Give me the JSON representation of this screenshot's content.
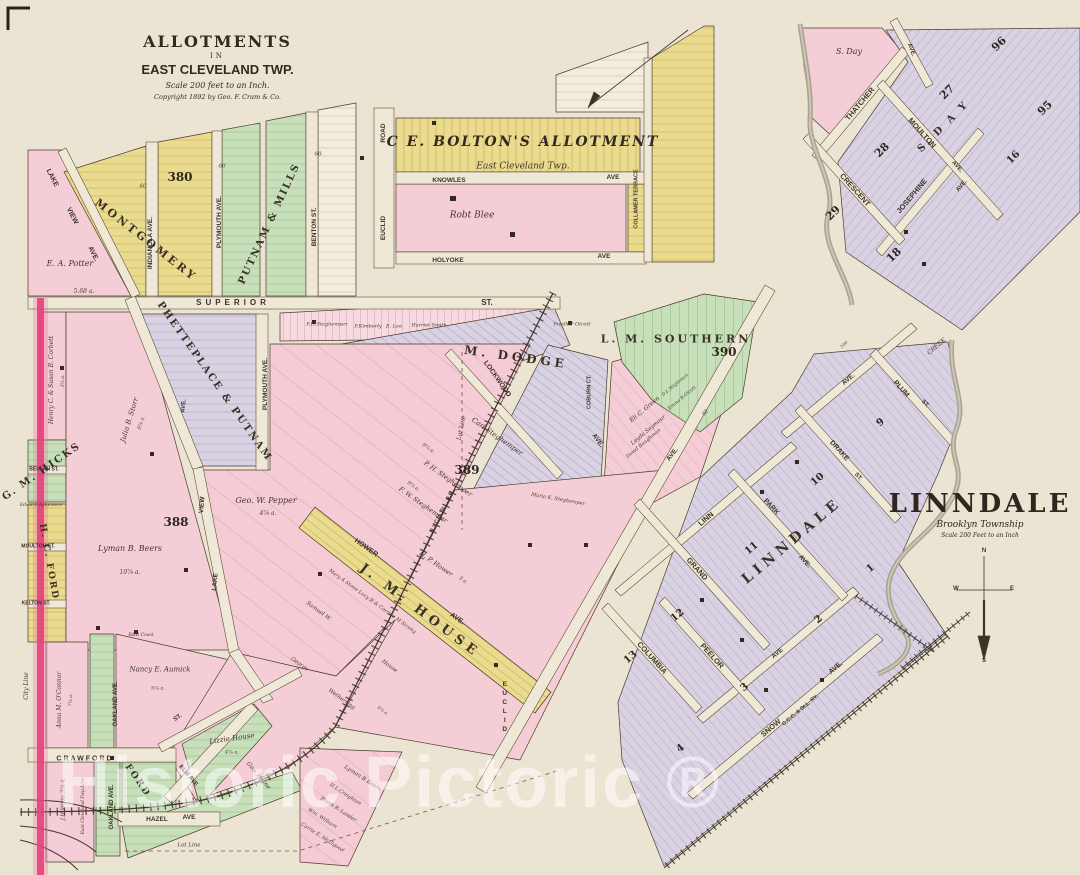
{
  "sheet": {
    "title_block": {
      "line1": "ALLOTMENTS",
      "line2": "IN",
      "line3": "EAST CLEVELAND TWP.",
      "line4": "Scale 200 feet to an Inch.",
      "line5": "Copyright 1892 by Geo. F. Cram & Co."
    },
    "linndale_title": {
      "title": "LINNDALE",
      "subtitle": "Brooklyn Township",
      "scale": "Scale 200 Feet to an Inch"
    },
    "watermark": "Historic Pictoric ®"
  },
  "colors": {
    "paper": "#ece4d3",
    "pink": "#f5cdd6",
    "yellow": "#eadb8d",
    "green": "#c7e0ba",
    "lavender": "#d9d2e3",
    "city_line": "#e63f7d",
    "creek": "#a9a291",
    "ink": "#4a3c2c",
    "watermark": "rgba(255,255,255,0.52)"
  },
  "map_labels": [
    {
      "t": "LAKE",
      "x": 52,
      "y": 178,
      "r": 63,
      "s": 7,
      "k": "st"
    },
    {
      "t": "VIEW",
      "x": 72,
      "y": 216,
      "r": 63,
      "s": 7,
      "k": "st"
    },
    {
      "t": "AVE.",
      "x": 93,
      "y": 254,
      "r": 63,
      "s": 7,
      "k": "st"
    },
    {
      "t": "E. A. Potter",
      "x": 70,
      "y": 264,
      "r": 0,
      "s": 8,
      "k": "ow"
    },
    {
      "t": "5.68 a.",
      "x": 84,
      "y": 292,
      "r": 0,
      "s": 6,
      "k": "ti"
    },
    {
      "t": "MONTGOMERY",
      "x": 146,
      "y": 240,
      "r": 38,
      "s": 11,
      "k": "al",
      "ls": 3
    },
    {
      "t": "380",
      "x": 180,
      "y": 177,
      "r": 0,
      "s": 12,
      "k": "nm"
    },
    {
      "t": "INDIANOLA AVE.",
      "x": 151,
      "y": 243,
      "r": -90,
      "s": 6.5,
      "k": "st"
    },
    {
      "t": "60",
      "x": 143,
      "y": 187,
      "r": 0,
      "s": 5.5,
      "k": "ti"
    },
    {
      "t": "60",
      "x": 222,
      "y": 167,
      "r": 0,
      "s": 5.5,
      "k": "ti"
    },
    {
      "t": "60",
      "x": 318,
      "y": 155,
      "r": 0,
      "s": 5.5,
      "k": "ti"
    },
    {
      "t": "PLYMOUTH AVE.",
      "x": 220,
      "y": 222,
      "r": -90,
      "s": 6.5,
      "k": "st"
    },
    {
      "t": "PUTNAM & MILLS",
      "x": 270,
      "y": 224,
      "r": -65,
      "s": 10,
      "k": "al",
      "ls": 2
    },
    {
      "t": "BENTON ST.",
      "x": 315,
      "y": 227,
      "r": -90,
      "s": 6.5,
      "k": "st"
    },
    {
      "t": "SUPERIOR",
      "x": 233,
      "y": 303,
      "r": 0,
      "s": 8,
      "k": "st",
      "ls": 4
    },
    {
      "t": "ST.",
      "x": 487,
      "y": 303,
      "r": 0,
      "s": 8,
      "k": "st"
    },
    {
      "t": "ROAD",
      "x": 384,
      "y": 133,
      "r": -90,
      "s": 6.5,
      "k": "st"
    },
    {
      "t": "EUCLID",
      "x": 384,
      "y": 228,
      "r": -90,
      "s": 6.5,
      "k": "st"
    },
    {
      "t": "C E. BOLTON'S ALLOTMENT",
      "x": 523,
      "y": 142,
      "r": 0,
      "s": 14,
      "k": "alit",
      "ls": 2,
      "n": "bolton-allotment-title"
    },
    {
      "t": "East Cleveland Twp.",
      "x": 523,
      "y": 167,
      "r": 0,
      "s": 9,
      "k": "ow",
      "n": "bolton-allotment-subtitle"
    },
    {
      "t": "KNOWLES",
      "x": 449,
      "y": 181,
      "r": 0,
      "s": 6.5,
      "k": "st"
    },
    {
      "t": "AVE",
      "x": 613,
      "y": 178,
      "r": 0,
      "s": 6.5,
      "k": "st"
    },
    {
      "t": "Robt Blee",
      "x": 472,
      "y": 216,
      "r": 0,
      "s": 9,
      "k": "ow"
    },
    {
      "t": "HOLYOKE",
      "x": 448,
      "y": 261,
      "r": 0,
      "s": 6.5,
      "k": "st"
    },
    {
      "t": "AVE",
      "x": 604,
      "y": 257,
      "r": 0,
      "s": 6.5,
      "k": "st"
    },
    {
      "t": "COLLAMER TERRACE",
      "x": 637,
      "y": 199,
      "r": -90,
      "s": 5.5,
      "k": "st"
    },
    {
      "t": "S. Day",
      "x": 849,
      "y": 52,
      "r": 0,
      "s": 8,
      "k": "ow"
    },
    {
      "t": "AVE.",
      "x": 911,
      "y": 50,
      "r": 70,
      "s": 6,
      "k": "st"
    },
    {
      "t": "96",
      "x": 999,
      "y": 44,
      "r": -45,
      "s": 11,
      "k": "nm"
    },
    {
      "t": "27",
      "x": 947,
      "y": 92,
      "r": -45,
      "s": 11,
      "k": "nm"
    },
    {
      "t": "95",
      "x": 1045,
      "y": 108,
      "r": -45,
      "s": 11,
      "k": "nm"
    },
    {
      "t": "28",
      "x": 882,
      "y": 150,
      "r": -45,
      "s": 11,
      "k": "nm"
    },
    {
      "t": "29",
      "x": 833,
      "y": 213,
      "r": -45,
      "s": 11,
      "k": "nm"
    },
    {
      "t": "16",
      "x": 1014,
      "y": 158,
      "r": -45,
      "s": 10,
      "k": "nm"
    },
    {
      "t": "18",
      "x": 894,
      "y": 255,
      "r": -45,
      "s": 11,
      "k": "nm"
    },
    {
      "t": "THATCHER",
      "x": 860,
      "y": 104,
      "r": -50,
      "s": 7.5,
      "k": "st"
    },
    {
      "t": "MOULTON",
      "x": 922,
      "y": 133,
      "r": 48,
      "s": 7.5,
      "k": "st"
    },
    {
      "t": "AVE.",
      "x": 957,
      "y": 167,
      "r": 48,
      "s": 6,
      "k": "st"
    },
    {
      "t": "S. D A Y",
      "x": 944,
      "y": 127,
      "r": -45,
      "s": 10,
      "k": "al",
      "ls": 3
    },
    {
      "t": "CRESCENT",
      "x": 855,
      "y": 190,
      "r": 48,
      "s": 7.5,
      "k": "st"
    },
    {
      "t": "JOSEPHINE",
      "x": 912,
      "y": 196,
      "r": -50,
      "s": 7.5,
      "k": "st"
    },
    {
      "t": "AVE.",
      "x": 962,
      "y": 186,
      "r": -50,
      "s": 6,
      "k": "st"
    },
    {
      "t": "CREEK",
      "x": 937,
      "y": 347,
      "r": -40,
      "s": 6,
      "k": "ow"
    },
    {
      "t": "M. DODGE",
      "x": 516,
      "y": 357,
      "r": 8,
      "s": 12,
      "k": "al",
      "ls": 4
    },
    {
      "t": "LOCKWOOD",
      "x": 497,
      "y": 379,
      "r": 55,
      "s": 7,
      "k": "st"
    },
    {
      "t": "AVE.",
      "x": 597,
      "y": 441,
      "r": 55,
      "s": 6.5,
      "k": "st"
    },
    {
      "t": "COBURN CT.",
      "x": 590,
      "y": 392,
      "r": -90,
      "s": 5.5,
      "k": "st"
    },
    {
      "t": "F.H.Steghemper",
      "x": 327,
      "y": 325,
      "r": 0,
      "s": 5,
      "k": "ti"
    },
    {
      "t": "F.Kimberly",
      "x": 368,
      "y": 327,
      "r": 0,
      "s": 5,
      "k": "ti"
    },
    {
      "t": "E. Lee",
      "x": 394,
      "y": 327,
      "r": 0,
      "s": 5,
      "k": "ti"
    },
    {
      "t": "Harriet Smith",
      "x": 429,
      "y": 326,
      "r": 0,
      "s": 5,
      "k": "ti"
    },
    {
      "t": "Fredk.P Olcott",
      "x": 572,
      "y": 325,
      "r": 0,
      "s": 5,
      "k": "ti"
    },
    {
      "t": "389",
      "x": 467,
      "y": 470,
      "r": 0,
      "s": 12,
      "k": "nm"
    },
    {
      "t": "Carl Steghemper",
      "x": 497,
      "y": 437,
      "r": 35,
      "s": 7,
      "k": "ow"
    },
    {
      "t": "9⅞ a.",
      "x": 428,
      "y": 449,
      "r": 35,
      "s": 5,
      "k": "ti"
    },
    {
      "t": "P. H. Steghemper",
      "x": 448,
      "y": 479,
      "r": 35,
      "s": 6.5,
      "k": "ow"
    },
    {
      "t": "9⅞ a.",
      "x": 413,
      "y": 487,
      "r": 35,
      "s": 5,
      "k": "ti"
    },
    {
      "t": "F. W. Steghemper",
      "x": 423,
      "y": 505,
      "r": 35,
      "s": 6.5,
      "k": "ow"
    },
    {
      "t": "H. P. Hower",
      "x": 436,
      "y": 564,
      "r": 35,
      "s": 6.5,
      "k": "ow"
    },
    {
      "t": "5 a.",
      "x": 463,
      "y": 581,
      "r": 35,
      "s": 5,
      "k": "ti"
    },
    {
      "t": "HOWER",
      "x": 366,
      "y": 548,
      "r": 35,
      "s": 7,
      "k": "st"
    },
    {
      "t": "AVE.",
      "x": 457,
      "y": 619,
      "r": 35,
      "s": 7,
      "k": "st"
    },
    {
      "t": "J. M. HOUSE",
      "x": 420,
      "y": 611,
      "r": 37,
      "s": 13,
      "k": "al",
      "ls": 5
    },
    {
      "t": "Mary A Stone Lucy R & Corrine M Strong",
      "x": 372,
      "y": 602,
      "r": 36,
      "s": 5,
      "k": "ti"
    },
    {
      "t": "Samuel W.",
      "x": 318,
      "y": 612,
      "r": 36,
      "s": 5.5,
      "k": "ow"
    },
    {
      "t": "House",
      "x": 389,
      "y": 667,
      "r": 36,
      "s": 5.5,
      "k": "ow"
    },
    {
      "t": "George",
      "x": 299,
      "y": 665,
      "r": 36,
      "s": 5.5,
      "k": "ow"
    },
    {
      "t": "Wetherring",
      "x": 341,
      "y": 700,
      "r": 36,
      "s": 5.5,
      "k": "ow"
    },
    {
      "t": "4⅞ a.",
      "x": 382,
      "y": 712,
      "r": 36,
      "s": 4.5,
      "k": "ti"
    },
    {
      "t": "N.Y.C. & St.L. R.R.",
      "x": 443,
      "y": 512,
      "r": -63,
      "s": 5.5,
      "k": "st"
    },
    {
      "t": "Maria K. Steghemper",
      "x": 558,
      "y": 500,
      "r": 10,
      "s": 5,
      "k": "ti"
    },
    {
      "t": "L. M. SOUTHERN",
      "x": 676,
      "y": 339,
      "r": 0,
      "s": 11,
      "k": "al",
      "ls": 3
    },
    {
      "t": "390",
      "x": 724,
      "y": 352,
      "r": 0,
      "s": 12,
      "k": "nm"
    },
    {
      "t": "Eli C. Green",
      "x": 645,
      "y": 410,
      "r": -40,
      "s": 6,
      "k": "ow"
    },
    {
      "t": "Leyda Seymour",
      "x": 649,
      "y": 431,
      "r": -40,
      "s": 5.5,
      "k": "ow"
    },
    {
      "t": "Dowd Baughman",
      "x": 644,
      "y": 444,
      "r": -40,
      "s": 5,
      "k": "ti"
    },
    {
      "t": "D.L.Wightman",
      "x": 676,
      "y": 386,
      "r": -40,
      "s": 4.5,
      "k": "ti"
    },
    {
      "t": "Emma R.Olcott",
      "x": 683,
      "y": 399,
      "r": -40,
      "s": 4.5,
      "k": "ti"
    },
    {
      "t": "AVE.",
      "x": 673,
      "y": 455,
      "r": -52,
      "s": 6.5,
      "k": "st"
    },
    {
      "t": "80",
      "x": 706,
      "y": 413,
      "r": -52,
      "s": 5,
      "k": "ti"
    },
    {
      "t": "EUCLID",
      "x": 504,
      "y": 708,
      "r": 0,
      "s": 6.5,
      "k": "vs"
    },
    {
      "t": "LINN",
      "x": 706,
      "y": 519,
      "r": -40,
      "s": 7.5,
      "k": "st"
    },
    {
      "t": "GRAND",
      "x": 697,
      "y": 569,
      "r": 48,
      "s": 7.5,
      "k": "st"
    },
    {
      "t": "COLUMBIA",
      "x": 652,
      "y": 658,
      "r": 48,
      "s": 7.5,
      "k": "st"
    },
    {
      "t": "PEELOR",
      "x": 712,
      "y": 656,
      "r": 48,
      "s": 7.5,
      "k": "st"
    },
    {
      "t": "AVE",
      "x": 778,
      "y": 654,
      "r": -40,
      "s": 6.5,
      "k": "st"
    },
    {
      "t": "PARK",
      "x": 771,
      "y": 507,
      "r": 48,
      "s": 7,
      "k": "st"
    },
    {
      "t": "AVE.",
      "x": 804,
      "y": 562,
      "r": 48,
      "s": 6.5,
      "k": "st"
    },
    {
      "t": "DRAKE",
      "x": 839,
      "y": 451,
      "r": 48,
      "s": 7,
      "k": "st"
    },
    {
      "t": "ST.",
      "x": 858,
      "y": 477,
      "r": 48,
      "s": 6,
      "k": "st"
    },
    {
      "t": "PLUM",
      "x": 901,
      "y": 389,
      "r": 48,
      "s": 7,
      "k": "st"
    },
    {
      "t": "ST.",
      "x": 925,
      "y": 404,
      "r": 48,
      "s": 6,
      "k": "st"
    },
    {
      "t": "AVE.",
      "x": 849,
      "y": 380,
      "r": -40,
      "s": 6.5,
      "k": "st"
    },
    {
      "t": "100",
      "x": 845,
      "y": 346,
      "r": -40,
      "s": 4.5,
      "k": "ti"
    },
    {
      "t": "SNOW",
      "x": 771,
      "y": 728,
      "r": -40,
      "s": 7.5,
      "k": "st"
    },
    {
      "t": "AVE.",
      "x": 836,
      "y": 668,
      "r": -40,
      "s": 7,
      "k": "st"
    },
    {
      "t": "C.C.C. & St.L. RY.",
      "x": 801,
      "y": 711,
      "r": -40,
      "s": 5.5,
      "k": "st"
    },
    {
      "t": "LINNDALE",
      "x": 792,
      "y": 541,
      "r": -40,
      "s": 14,
      "k": "al",
      "ls": 5,
      "n": "linndale-blocks-label"
    },
    {
      "t": "9",
      "x": 881,
      "y": 423,
      "r": -40,
      "s": 10,
      "k": "nm"
    },
    {
      "t": "10",
      "x": 818,
      "y": 480,
      "r": -40,
      "s": 10,
      "k": "nm"
    },
    {
      "t": "11",
      "x": 752,
      "y": 549,
      "r": -40,
      "s": 10,
      "k": "nm"
    },
    {
      "t": "12",
      "x": 678,
      "y": 616,
      "r": -40,
      "s": 10,
      "k": "nm"
    },
    {
      "t": "13",
      "x": 631,
      "y": 658,
      "r": -40,
      "s": 10,
      "k": "nm"
    },
    {
      "t": "1",
      "x": 871,
      "y": 569,
      "r": -40,
      "s": 10,
      "k": "nm"
    },
    {
      "t": "2",
      "x": 819,
      "y": 620,
      "r": -40,
      "s": 10,
      "k": "nm"
    },
    {
      "t": "3",
      "x": 745,
      "y": 688,
      "r": -40,
      "s": 10,
      "k": "nm"
    },
    {
      "t": "4",
      "x": 681,
      "y": 749,
      "r": -40,
      "s": 10,
      "k": "nm"
    },
    {
      "t": "Henry C. & Susan B. Corbett",
      "x": 52,
      "y": 380,
      "r": -90,
      "s": 6,
      "k": "ow"
    },
    {
      "t": "3⅞ a.",
      "x": 64,
      "y": 381,
      "r": -90,
      "s": 4.5,
      "k": "ti"
    },
    {
      "t": "G. M. HICKS",
      "x": 42,
      "y": 472,
      "r": -35,
      "s": 10,
      "k": "al",
      "ls": 2
    },
    {
      "t": "BEULAH ST.",
      "x": 44,
      "y": 470,
      "r": 0,
      "s": 5,
      "k": "st"
    },
    {
      "t": "Edward Bakemore",
      "x": 41,
      "y": 506,
      "r": 0,
      "s": 4.5,
      "k": "ti"
    },
    {
      "t": "MOULTON ST.",
      "x": 38,
      "y": 547,
      "r": 0,
      "s": 5,
      "k": "st"
    },
    {
      "t": "H. C. FORD",
      "x": 48,
      "y": 562,
      "r": 80,
      "s": 9,
      "k": "al",
      "ls": 2
    },
    {
      "t": "KELTON ST.",
      "x": 36,
      "y": 604,
      "r": 0,
      "s": 5,
      "k": "st"
    },
    {
      "t": "Julia B. Storr",
      "x": 130,
      "y": 420,
      "r": -73,
      "s": 7,
      "k": "ow"
    },
    {
      "t": "9⅞ a.",
      "x": 142,
      "y": 423,
      "r": -73,
      "s": 5,
      "k": "ti"
    },
    {
      "t": "388",
      "x": 176,
      "y": 522,
      "r": 0,
      "s": 12,
      "k": "nm"
    },
    {
      "t": "Lyman B. Beers",
      "x": 130,
      "y": 549,
      "r": 0,
      "s": 8,
      "k": "ow"
    },
    {
      "t": "10⅞ a.",
      "x": 130,
      "y": 573,
      "r": 0,
      "s": 6,
      "k": "ti"
    },
    {
      "t": "Geo. W. Pepper",
      "x": 266,
      "y": 501,
      "r": 0,
      "s": 8,
      "k": "ow"
    },
    {
      "t": "4⅞ a.",
      "x": 268,
      "y": 514,
      "r": 0,
      "s": 6,
      "k": "ti"
    },
    {
      "t": "PHETTEPLACE & PUTNAM",
      "x": 214,
      "y": 382,
      "r": 55,
      "s": 10,
      "k": "al",
      "ls": 2
    },
    {
      "t": "PLYMOUTH AVE.",
      "x": 266,
      "y": 384,
      "r": -90,
      "s": 6.5,
      "k": "st"
    },
    {
      "t": "AVE.",
      "x": 184,
      "y": 406,
      "r": -85,
      "s": 6,
      "k": "st"
    },
    {
      "t": "VIEW",
      "x": 203,
      "y": 505,
      "r": -85,
      "s": 6.5,
      "k": "st"
    },
    {
      "t": "LAKE",
      "x": 216,
      "y": 582,
      "r": -85,
      "s": 6.5,
      "k": "st"
    },
    {
      "t": "Lot Line",
      "x": 462,
      "y": 428,
      "r": -78,
      "s": 6,
      "k": "ow"
    },
    {
      "t": "City Line",
      "x": 27,
      "y": 686,
      "r": -90,
      "s": 6,
      "k": "ow"
    },
    {
      "t": "CRAWFORD",
      "x": 85,
      "y": 759,
      "r": 0,
      "s": 7,
      "k": "st",
      "ls": 2
    },
    {
      "t": "Anna M. O'Connor",
      "x": 60,
      "y": 700,
      "r": -90,
      "s": 6,
      "k": "ow"
    },
    {
      "t": "7⅞ a.",
      "x": 72,
      "y": 700,
      "r": -90,
      "s": 4.5,
      "k": "ti"
    },
    {
      "t": "OAKLAND AVE.",
      "x": 116,
      "y": 704,
      "r": -90,
      "s": 6,
      "k": "st"
    },
    {
      "t": "OAKLAND AVE.",
      "x": 112,
      "y": 807,
      "r": -90,
      "s": 6,
      "k": "st"
    },
    {
      "t": "J.H.Wade 2⅞ a.",
      "x": 64,
      "y": 799,
      "r": -90,
      "s": 5.5,
      "k": "ow"
    },
    {
      "t": "East Cleveland Twp.Line",
      "x": 84,
      "y": 806,
      "r": -90,
      "s": 4.5,
      "k": "ti"
    },
    {
      "t": "HAZEL",
      "x": 157,
      "y": 820,
      "r": 0,
      "s": 6.5,
      "k": "st"
    },
    {
      "t": "AVE",
      "x": 189,
      "y": 818,
      "r": 0,
      "s": 6.5,
      "k": "st"
    },
    {
      "t": "Lot Line",
      "x": 189,
      "y": 846,
      "r": 0,
      "s": 5.5,
      "k": "ow"
    },
    {
      "t": "ELM AVE",
      "x": 188,
      "y": 776,
      "r": 50,
      "s": 6,
      "k": "st"
    },
    {
      "t": "ST.",
      "x": 178,
      "y": 718,
      "r": -35,
      "s": 6,
      "k": "st"
    },
    {
      "t": "Lizzie House",
      "x": 232,
      "y": 739,
      "r": -8,
      "s": 7,
      "k": "ow"
    },
    {
      "t": "4⅞ a.",
      "x": 232,
      "y": 753,
      "r": 0,
      "s": 5,
      "k": "ti"
    },
    {
      "t": "Nancy E. Aumick",
      "x": 160,
      "y": 670,
      "r": 0,
      "s": 7,
      "k": "ow"
    },
    {
      "t": "5⅞ a.",
      "x": 158,
      "y": 689,
      "r": 0,
      "s": 5,
      "k": "ti"
    },
    {
      "t": "R&R Coast",
      "x": 141,
      "y": 636,
      "r": 0,
      "s": 4.5,
      "k": "ti"
    },
    {
      "t": "FORD",
      "x": 137,
      "y": 781,
      "r": 55,
      "s": 9,
      "k": "al",
      "ls": 2
    },
    {
      "t": "Geo. Payne",
      "x": 258,
      "y": 776,
      "r": 50,
      "s": 6,
      "k": "ow"
    },
    {
      "t": "Lyman B Beers",
      "x": 362,
      "y": 779,
      "r": 33,
      "s": 5.5,
      "k": "ow"
    },
    {
      "t": "H.L.Creighton",
      "x": 345,
      "y": 795,
      "r": 33,
      "s": 5,
      "k": "ti"
    },
    {
      "t": "Frank R. Lander",
      "x": 338,
      "y": 810,
      "r": 33,
      "s": 5,
      "k": "ti"
    },
    {
      "t": "Wm. Wilburn",
      "x": 322,
      "y": 819,
      "r": 33,
      "s": 5,
      "k": "ti"
    },
    {
      "t": "Carrie E. McElgood",
      "x": 322,
      "y": 838,
      "r": 33,
      "s": 5,
      "k": "ti"
    },
    {
      "t": "N",
      "x": 984,
      "y": 551,
      "r": 0,
      "s": 6,
      "k": "st",
      "n": "compass-north-label"
    },
    {
      "t": "S",
      "x": 984,
      "y": 661,
      "r": 0,
      "s": 6,
      "k": "st",
      "n": "compass-south-label"
    },
    {
      "t": "W",
      "x": 956,
      "y": 589,
      "r": 0,
      "s": 6,
      "k": "st",
      "n": "compass-west-label"
    },
    {
      "t": "E",
      "x": 1012,
      "y": 589,
      "r": 0,
      "s": 6,
      "k": "st",
      "n": "compass-east-label"
    }
  ]
}
